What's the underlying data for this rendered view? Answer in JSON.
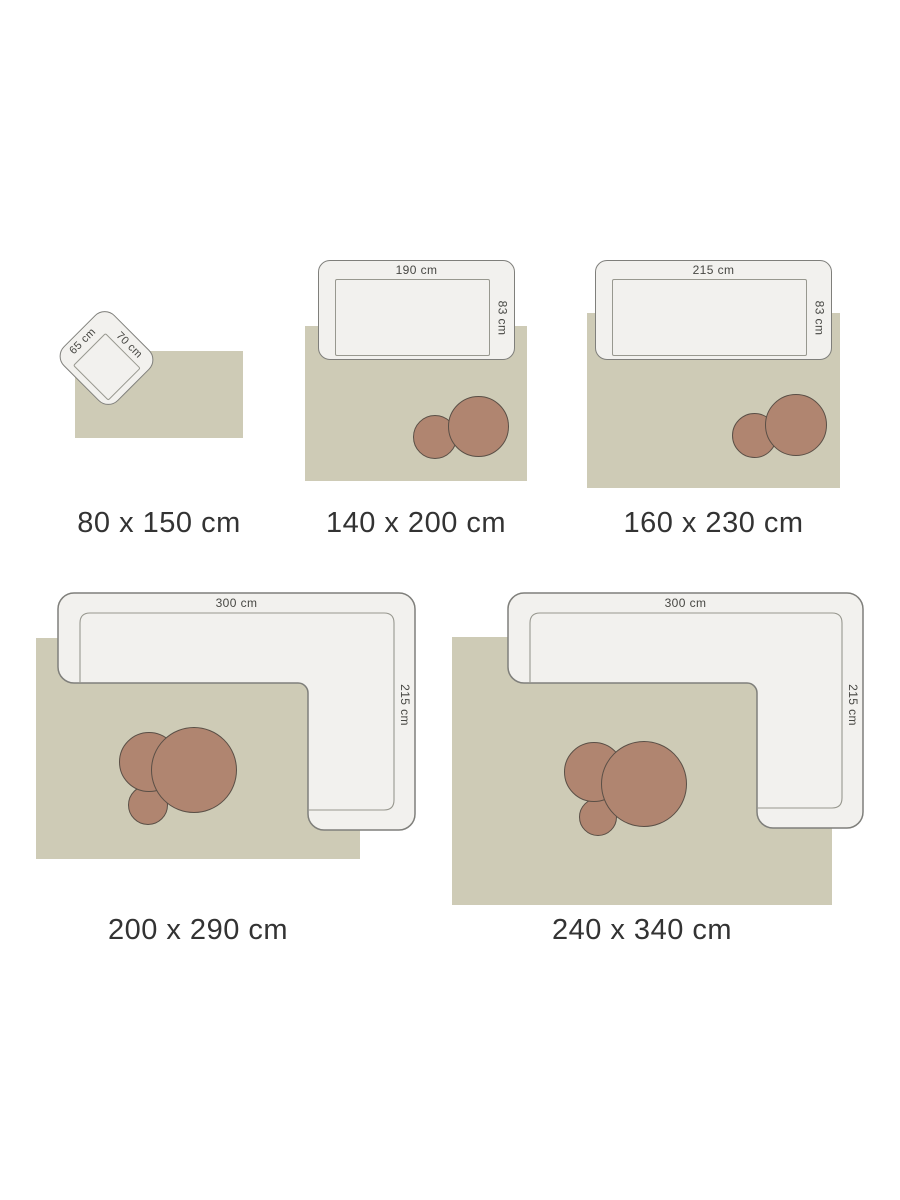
{
  "diagram": {
    "kind": "rug-size-guide",
    "colors": {
      "background": "#ffffff",
      "rug_fill": "#cecbb6",
      "sofa_fill": "#f2f1ee",
      "sofa_outline": "#7f7f7b",
      "seat_outline": "#98988f",
      "coffee_table_fill": "#b08570",
      "coffee_table_outline": "#5a4f46",
      "dimension_text": "#474743",
      "caption_text": "#333333"
    }
  },
  "panels": [
    {
      "caption": "80 x 150 cm",
      "furniture_type": "armchair",
      "dim_labels": {
        "depth": "65 cm",
        "width": "70 cm"
      }
    },
    {
      "caption": "140 x 200 cm",
      "furniture_type": "sofa",
      "dim_labels": {
        "width": "190 cm",
        "depth": "83 cm"
      }
    },
    {
      "caption": "160 x 230 cm",
      "furniture_type": "sofa",
      "dim_labels": {
        "width": "215 cm",
        "depth": "83 cm"
      }
    },
    {
      "caption": "200 x 290 cm",
      "furniture_type": "corner-sofa",
      "dim_labels": {
        "width": "300 cm",
        "depth": "215 cm"
      }
    },
    {
      "caption": "240 x 340 cm",
      "furniture_type": "corner-sofa",
      "dim_labels": {
        "width": "300 cm",
        "depth": "215 cm"
      }
    }
  ]
}
